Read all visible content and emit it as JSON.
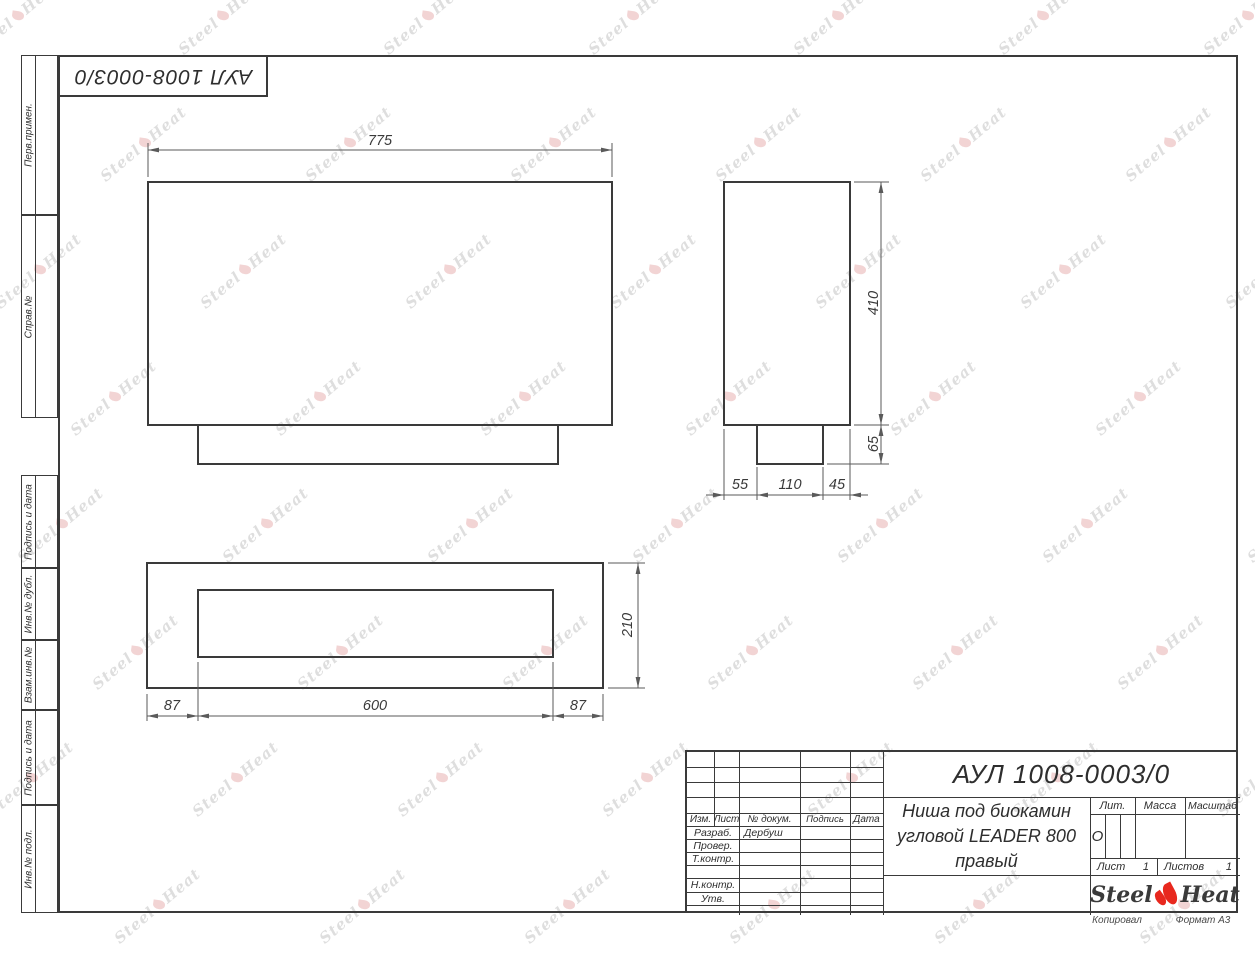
{
  "doc_number": "АУЛ 1008-0003/0",
  "watermark": {
    "steel": "Steel",
    "heat": "Heat"
  },
  "side_strip": {
    "labels": [
      "Перв.примен.",
      "Справ.№",
      "Подпись и дата",
      "Инв.№ дубл.",
      "Взам.инв.№",
      "Подпись и дата",
      "Инв.№ подл."
    ]
  },
  "dimensions": {
    "front_width": "775",
    "side_height": "410",
    "foot_height": "65",
    "depth_back": "55",
    "slot_depth": "110",
    "depth_front": "45",
    "depth_total": "210",
    "margin_left": "87",
    "slot_width": "600",
    "margin_right": "87"
  },
  "title_block": {
    "doc_number": "АУЛ 1008-0003/0",
    "title_lines": [
      "Ниша под биокамин",
      "угловой LEADER 800",
      "правый"
    ],
    "header": {
      "izm": "Изм.",
      "list": "Лист",
      "doc": "№ докум.",
      "sign": "Подпись",
      "date": "Дата"
    },
    "rows": [
      {
        "label": "Разраб.",
        "value": "Дербуш"
      },
      {
        "label": "Провер.",
        "value": ""
      },
      {
        "label": "Т.контр.",
        "value": ""
      },
      {
        "label": "",
        "value": ""
      },
      {
        "label": "Н.контр.",
        "value": ""
      },
      {
        "label": "Утв.",
        "value": ""
      }
    ],
    "lit": {
      "label": "Лит.",
      "value": "О"
    },
    "mass_label": "Масса",
    "scale_label": "Масштаб",
    "sheet": {
      "label": "Лист",
      "value": "1"
    },
    "sheets": {
      "label": "Листов",
      "value": "1"
    },
    "logo": {
      "steel": "Steel",
      "heat": "Heat"
    }
  },
  "footer": {
    "copied": "Копировал",
    "format": "Формат А3"
  },
  "colors": {
    "line": "#3a3a3a",
    "dim_line": "#5a5a5a",
    "logo_red": "#e8281e",
    "watermark_gray": "#9e9e9e",
    "watermark_pink": "#de9494"
  }
}
